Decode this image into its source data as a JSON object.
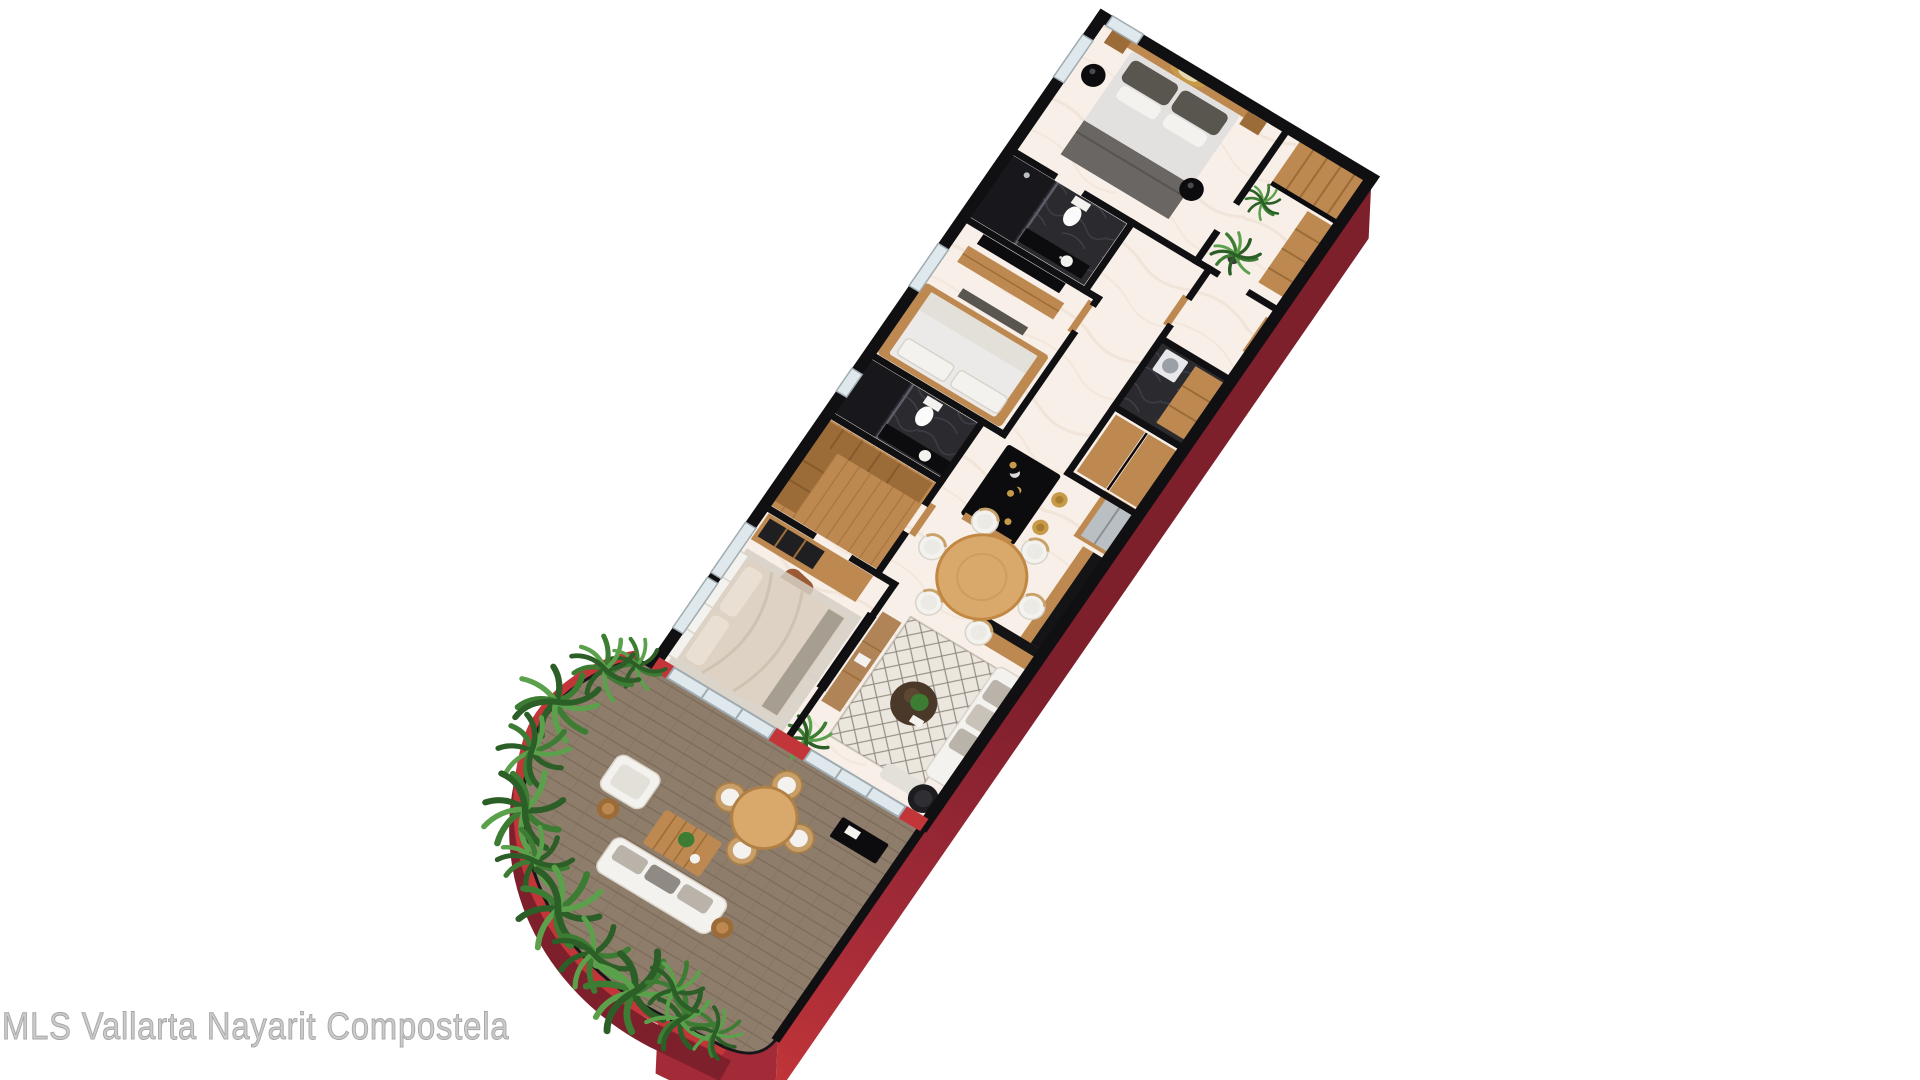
{
  "watermark": "MLS Vallarta Nayarit Compostela",
  "scene": {
    "type": "3d-floor-plan-rendering",
    "view": "isometric top-down render of an apartment, rotated about 31 degrees, white background",
    "rooms": [
      {
        "name": "master-bedroom",
        "furniture": [
          "double-bed",
          "wood-headboard",
          "nightstands",
          "black-sphere-pendant-lamps",
          "round-gold-wall-decor",
          "window"
        ]
      },
      {
        "name": "master-bathroom",
        "furniture": [
          "dark-tile-shower",
          "toilet",
          "black-counter-vanity-sink"
        ]
      },
      {
        "name": "entry-hall",
        "furniture": [
          "potted-plant",
          "wood-entry-door",
          "wood-wardrobe"
        ]
      },
      {
        "name": "bedroom-2",
        "furniture": [
          "wall-tv",
          "wood-tv-console",
          "platform-bed",
          "window"
        ]
      },
      {
        "name": "utility-room",
        "furniture": [
          "washer",
          "wood-shelving",
          "dark-tile-floor"
        ]
      },
      {
        "name": "bathroom-2",
        "furniture": [
          "dark-tile-shower",
          "toilet",
          "black-counter-vanity-sink"
        ]
      },
      {
        "name": "walk-in-closet",
        "furniture": [
          "wood-floor",
          "l-shaped-wardrobe"
        ]
      },
      {
        "name": "bedroom-3",
        "furniture": [
          "bed-beige-duvet",
          "tufted-headboard",
          "desk-shelf-unit",
          "leather-chair",
          "area-rug",
          "sliding-glass-door"
        ]
      },
      {
        "name": "kitchen",
        "furniture": [
          "black-island-with-wood-base",
          "three-pendant-lamps",
          "gold-bar-stools",
          "stainless-fridge",
          "wood-counter-black-top"
        ]
      },
      {
        "name": "dining-area",
        "furniture": [
          "round-wood-table",
          "six-white-chairs"
        ]
      },
      {
        "name": "living-room",
        "furniture": [
          "wall-tv",
          "wood-tv-console",
          "diamond-pattern-rug",
          "round-dark-coffee-table-with-plant",
          "white-sofa",
          "black-round-chair",
          "ottoman",
          "corner-plant",
          "sliding-glass-door"
        ]
      },
      {
        "name": "terrace",
        "furniture": [
          "wood-deck",
          "curved-red-planter-with-ferns",
          "outdoor-round-dining-table",
          "four-rattan-chairs",
          "outdoor-white-sofa",
          "outdoor-armchair",
          "slatted-coffee-table",
          "round-side-stools",
          "black-grill-console"
        ]
      }
    ]
  },
  "palette": {
    "bg": "#ffffff",
    "wall": "#101013",
    "wallLight": "#eef0f3",
    "floorMarble": "#f7efe8",
    "floorVein": "#ecd9c7",
    "tileDark": "#2a2a2f",
    "tileDarker": "#18181c",
    "glass": "#dfe8ec",
    "glassFrame": "#9fabb0",
    "wood": "#bd8950",
    "woodDark": "#9c6c38",
    "woodLight": "#d8a96b",
    "deck": "#8f7d6b",
    "deckLine": "#7c6a59",
    "redBright": "#c23538",
    "redMid": "#a32b38",
    "redDark": "#7e1f2c",
    "plant": "#3c7c33",
    "plantLight": "#5ba14c",
    "plantDark": "#2c5f27",
    "white": "#f4f2ee",
    "whiteDim": "#e3dfd9",
    "gray": "#8b8680",
    "grayDark": "#59554f",
    "gold": "#c79a49",
    "black": "#0c0c0e",
    "steel": "#babfc4",
    "leather": "#9a5a33",
    "beige": "#ddd2c3",
    "rug": "#ece7de",
    "rugLine": "#7d766c"
  }
}
